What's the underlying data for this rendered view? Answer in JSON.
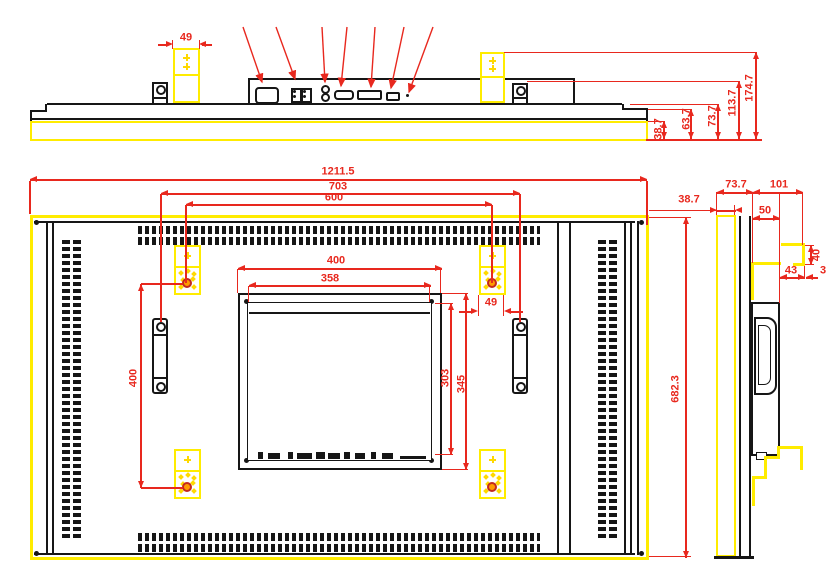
{
  "drawing_title": "Monitor outline dimension drawing",
  "views": {
    "top": "top-view",
    "rear": "rear-view",
    "side": "side-view"
  },
  "dims": {
    "top_bracket_w": "49",
    "top_h1": "38.7",
    "top_h2": "63.7",
    "top_h3": "73.7",
    "top_h4": "113.7",
    "top_h5": "174.7",
    "rear_w": "1211.5",
    "rear_handle_w": "703",
    "rear_vesa_w": "600",
    "rear_mount_w": "400",
    "rear_panel_w": "358",
    "rear_bracket_w": "49",
    "rear_vesa_h": "400",
    "rear_panel_h": "303",
    "rear_mount_h": "345",
    "rear_h": "682.3",
    "side_front": "38.7",
    "side_body": "73.7",
    "side_back": "101",
    "side_box": "50",
    "side_hook_w": "43",
    "side_hook_h": "40",
    "side_hook_t": "3"
  },
  "colors": {
    "highlight": "#ffec00",
    "dimension": "#e8281e",
    "line": "#161616",
    "hole_fill": "#ff9a00",
    "hole_ring": "#c3291c"
  }
}
